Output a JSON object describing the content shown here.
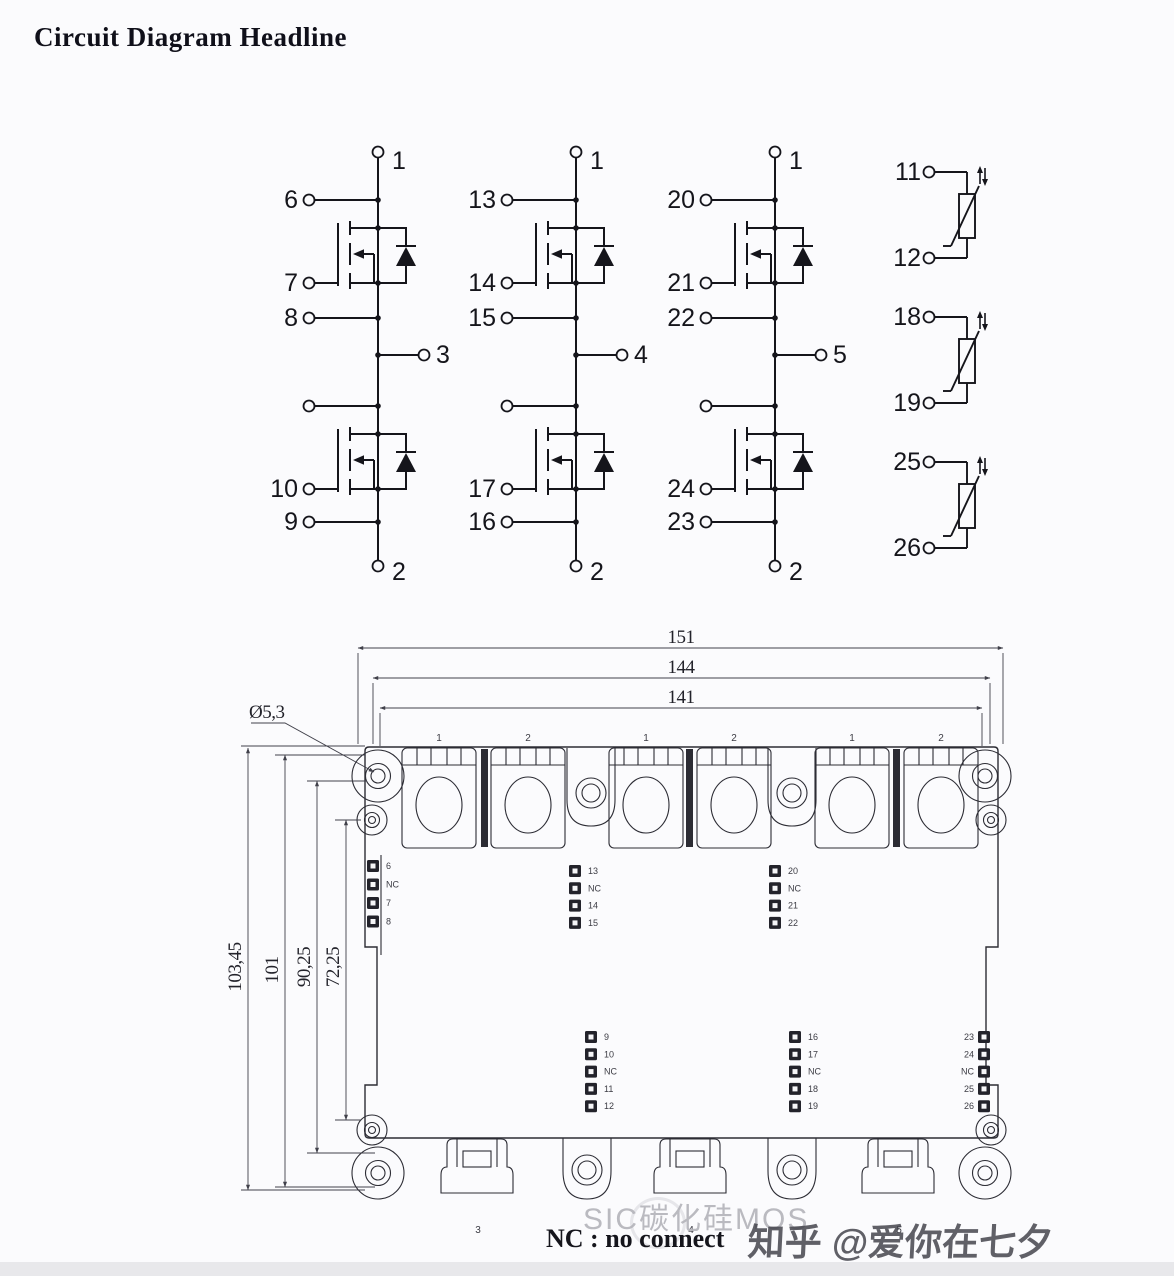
{
  "title": "Circuit Diagram Headline",
  "notes": {
    "nc": "NC : no connect"
  },
  "watermark": {
    "product": "SIC碳化硅MOS",
    "credit": "知乎 @爱你在七夕"
  },
  "circuits": [
    {
      "top_pin": "1",
      "drain_sense_pin": "6",
      "high_gate_pin": "7",
      "high_source_sense_pin": "8",
      "output_pin": "3",
      "low_gate_pin": "10",
      "low_source_sense_pin": "9",
      "bottom_pin": "2"
    },
    {
      "top_pin": "1",
      "drain_sense_pin": "13",
      "high_gate_pin": "14",
      "high_source_sense_pin": "15",
      "output_pin": "4",
      "low_gate_pin": "17",
      "low_source_sense_pin": "16",
      "bottom_pin": "2"
    },
    {
      "top_pin": "1",
      "drain_sense_pin": "20",
      "high_gate_pin": "21",
      "high_source_sense_pin": "22",
      "output_pin": "5",
      "low_gate_pin": "24",
      "low_source_sense_pin": "23",
      "bottom_pin": "2"
    }
  ],
  "thermistors": [
    {
      "top_pin": "11",
      "bottom_pin": "12"
    },
    {
      "top_pin": "18",
      "bottom_pin": "19"
    },
    {
      "top_pin": "25",
      "bottom_pin": "26"
    }
  ],
  "package": {
    "horizontal_dims": [
      "151",
      "144",
      "141"
    ],
    "vertical_dims": [
      "103,45",
      "101",
      "90,25",
      "72,25"
    ],
    "hole_dim": "Ø5,3",
    "top_terminal_labels": [
      "1",
      "2",
      "1",
      "2",
      "1",
      "2"
    ],
    "bottom_terminal_labels": [
      "3",
      "4",
      "5"
    ],
    "pin_groups": {
      "left_top": [
        "6",
        "NC",
        "7",
        "8"
      ],
      "mid_top": [
        "13",
        "NC",
        "14",
        "15"
      ],
      "right_top": [
        "20",
        "NC",
        "21",
        "22"
      ],
      "left_bottom": [
        "9",
        "10",
        "NC",
        "11",
        "12"
      ],
      "mid_bottom": [
        "16",
        "17",
        "NC",
        "18",
        "19"
      ],
      "right_edge": [
        "23",
        "24",
        "NC",
        "25",
        "26"
      ]
    }
  }
}
